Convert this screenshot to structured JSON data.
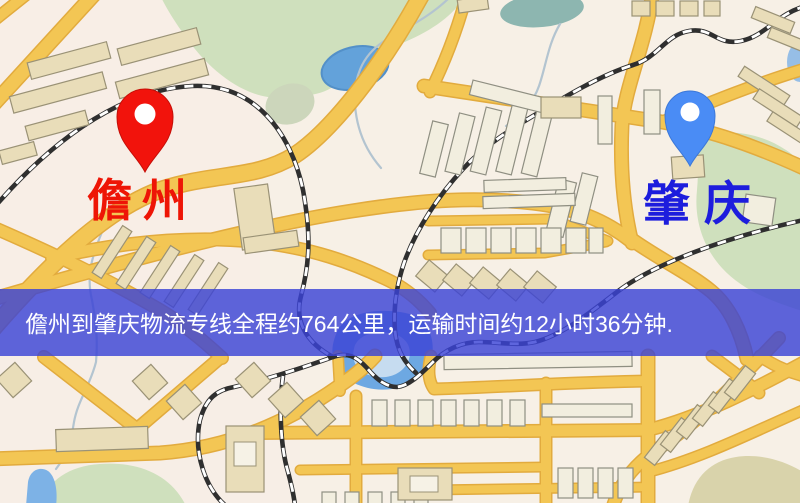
{
  "banner": {
    "text": "儋州到肇庆物流专线全程约764公里，运输时间约12小时36分钟.",
    "bg_color": "#3b43d5",
    "text_color": "#ffffff"
  },
  "markers": {
    "origin": {
      "label": "儋州",
      "pin_icon": "red-location-pin-icon",
      "pin_color": "#f2130c",
      "label_color": "#ee1506"
    },
    "destination": {
      "label": "肇庆",
      "pin_icon": "blue-location-pin-icon",
      "pin_color": "#4a8cf5",
      "label_color": "#1d1ddd"
    }
  },
  "route": {
    "from": "儋州",
    "to": "肇庆",
    "distance_km": 764,
    "duration_hours": 12,
    "duration_minutes": 36
  }
}
